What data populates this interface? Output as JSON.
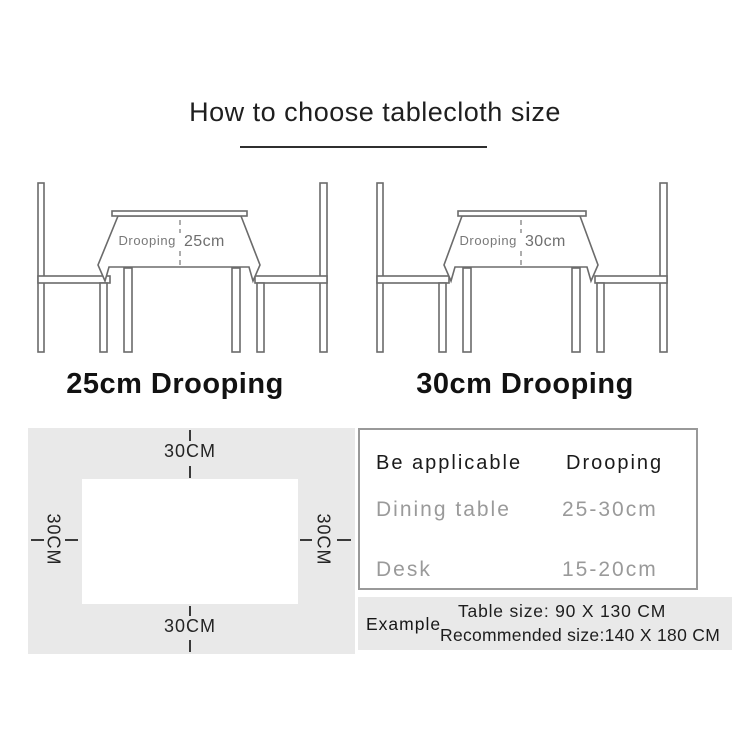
{
  "title": "How to choose tablecloth size",
  "illustrations": [
    {
      "drooping_word": "Drooping",
      "drooping_value": "25cm",
      "caption": "25cm Drooping"
    },
    {
      "drooping_word": "Drooping",
      "drooping_value": "30cm",
      "caption": "30cm Drooping"
    }
  ],
  "size_diagram": {
    "top_label": "30CM",
    "bottom_label": "30CM",
    "left_label": "30CM",
    "right_label": "30CM"
  },
  "spec_table": {
    "headers": [
      "Be applicable",
      "Drooping"
    ],
    "rows": [
      {
        "item": "Dining table",
        "value": "25-30cm"
      },
      {
        "item": "Desk",
        "value": "15-20cm"
      }
    ]
  },
  "example": {
    "label": "Example",
    "table_size": "Table size: 90 X 130 CM",
    "recommended_size": "Recommended size:140 X 180 CM"
  },
  "colors": {
    "sketch_line": "#6b6b6b",
    "panel_gray": "#e9e9e9",
    "muted_text": "#9a9a9a",
    "dark_text": "#1c1c1c",
    "table_border": "#999999"
  }
}
